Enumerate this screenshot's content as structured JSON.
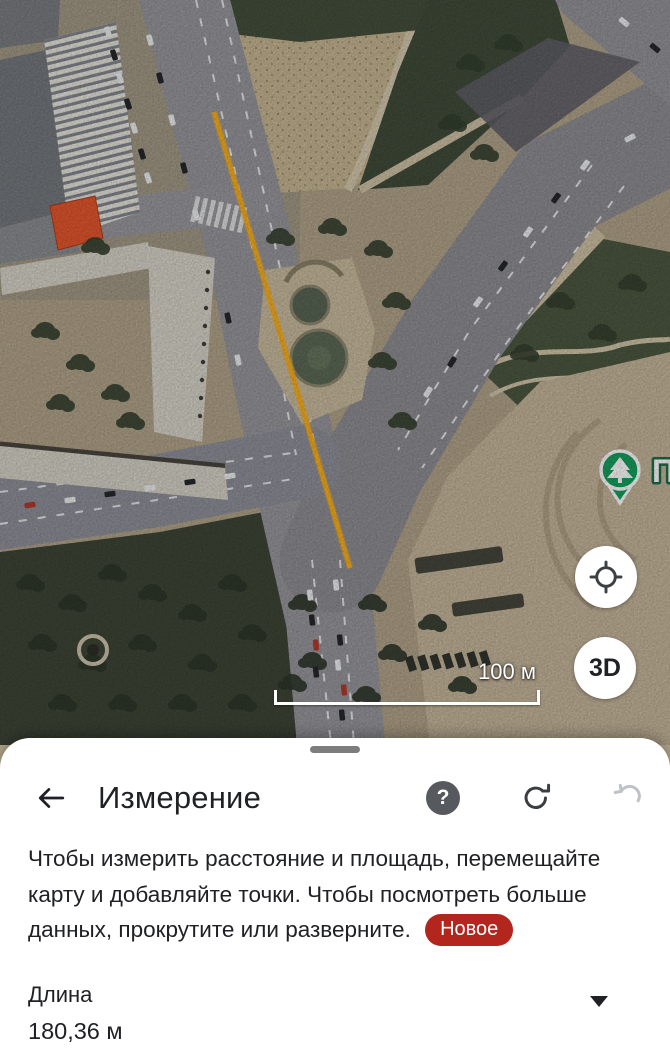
{
  "map": {
    "scale_label": "100 м",
    "pin_label": "П",
    "threed_label": "3D",
    "length_line": {
      "value_m": "180,36"
    },
    "colors": {
      "measure_line": "#F9AF1E",
      "pin_green": "#17A05E"
    }
  },
  "sheet": {
    "title": "Измерение",
    "help_glyph": "?",
    "description": "Чтобы измерить расстояние и площадь, перемещайте карту и добавляйте точки. Чтобы посмотреть больше данных, прокрутите или разверните.",
    "badge_label": "Новое",
    "length_label": "Длина",
    "length_value": "180,36 м",
    "colors": {
      "badge_red": "#B3261E",
      "text": "#202124"
    }
  }
}
